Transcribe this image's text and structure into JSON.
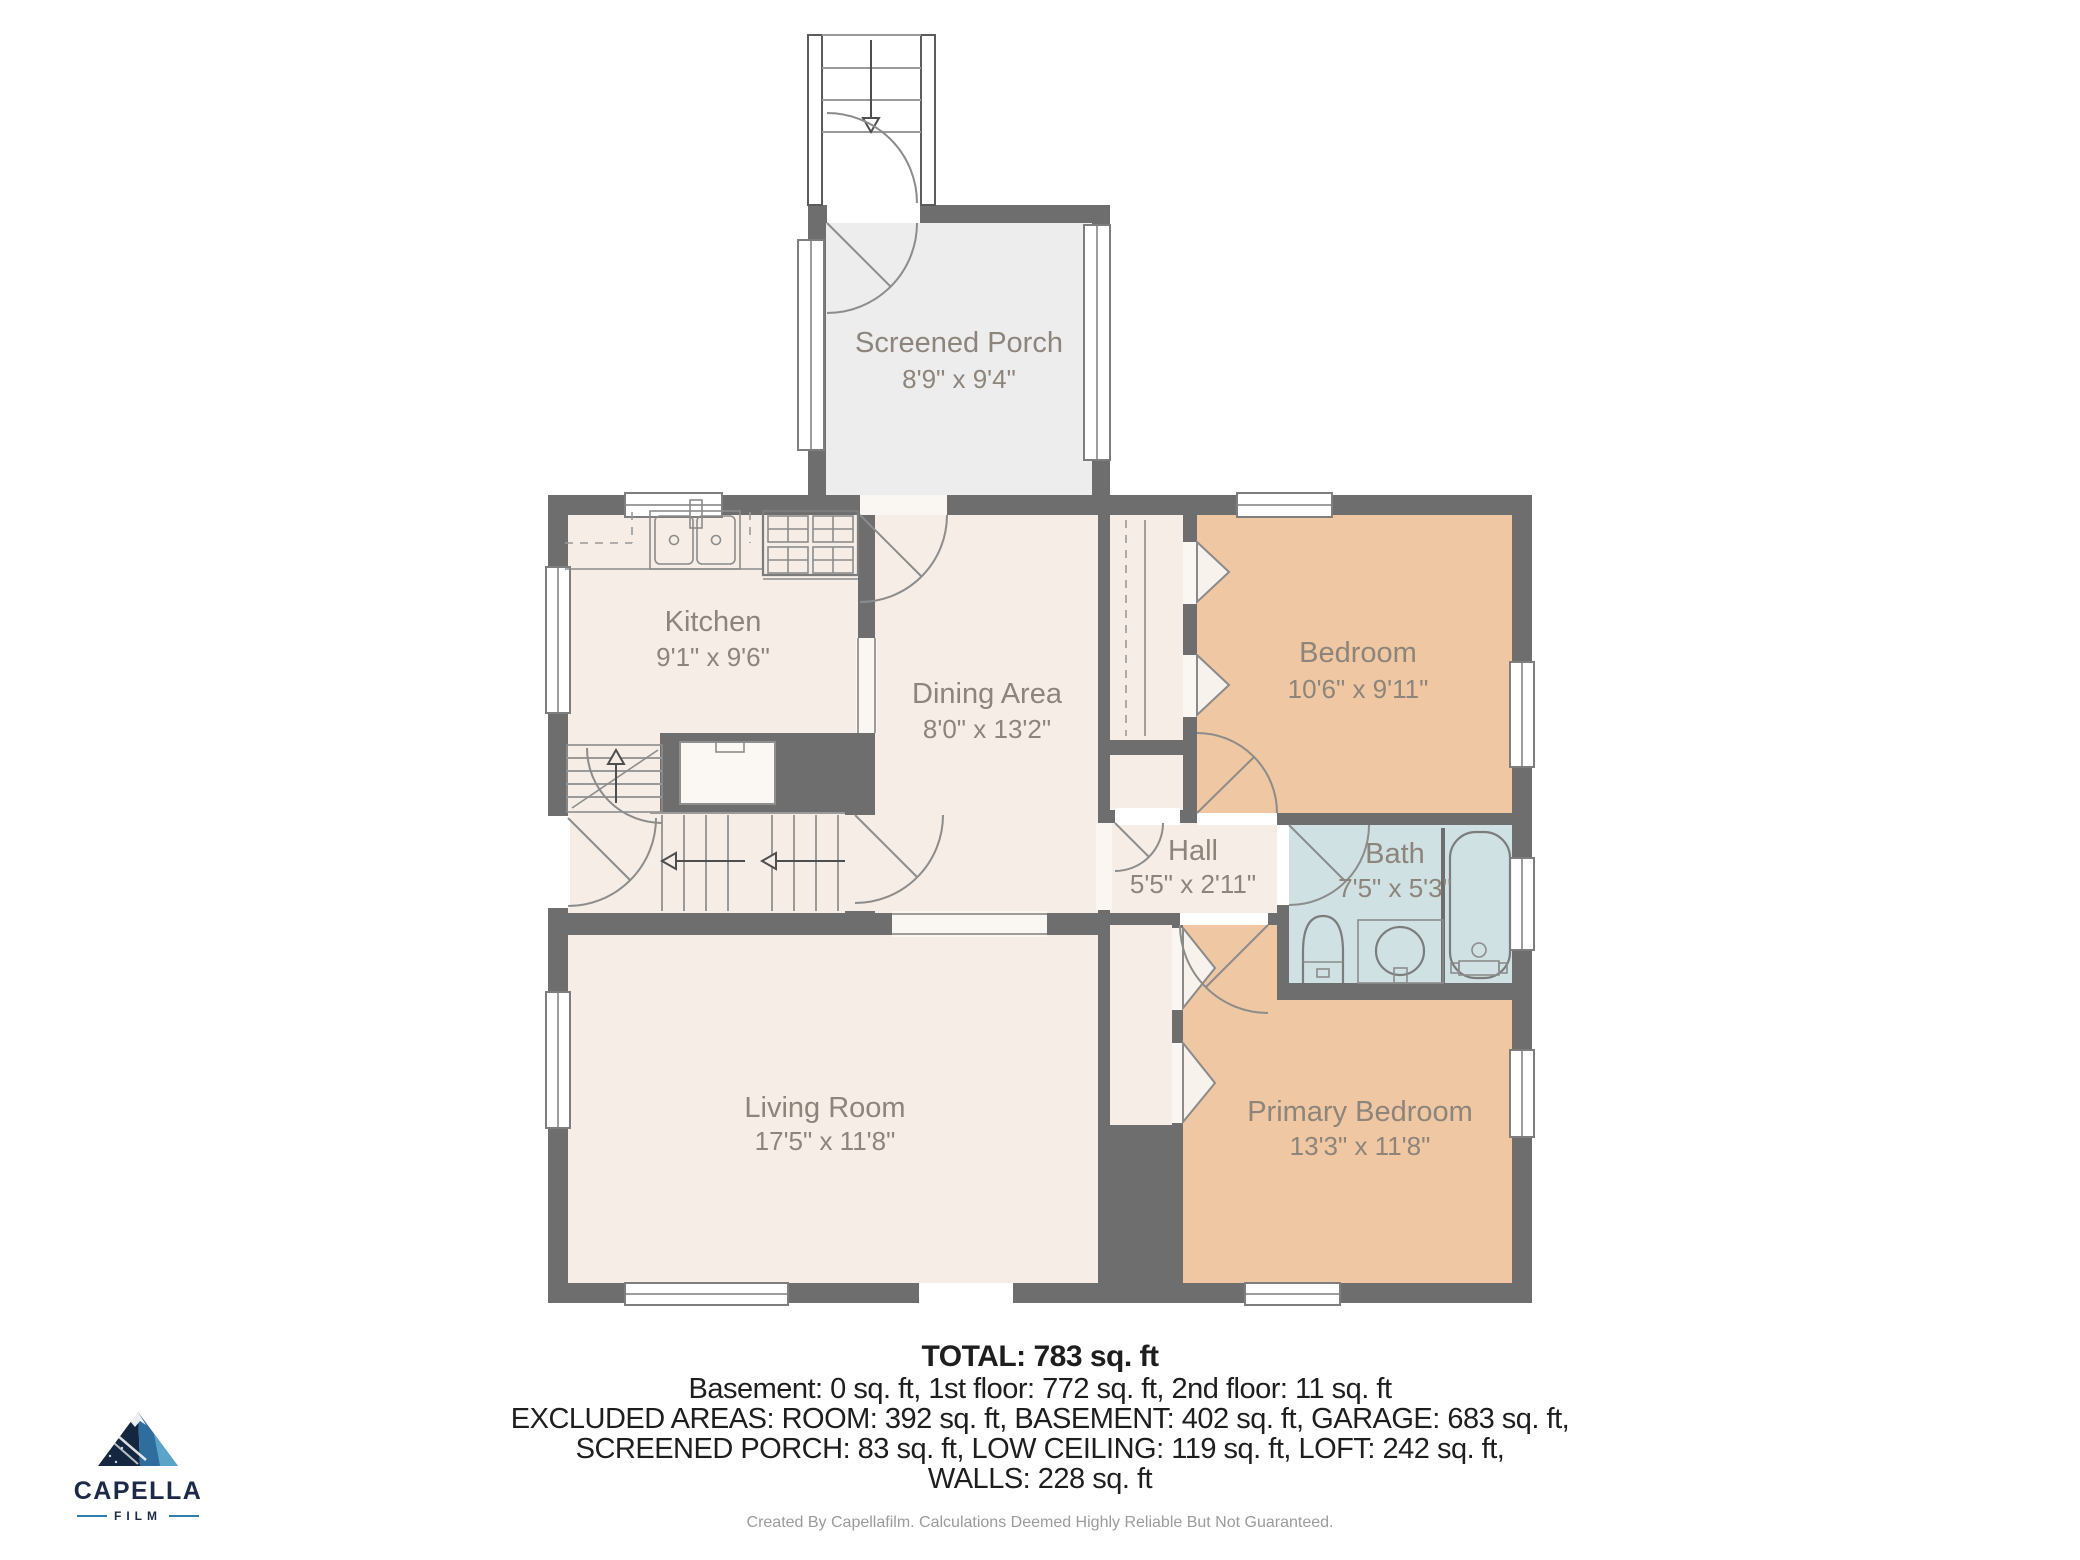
{
  "rooms": [
    {
      "name": "Screened Porch",
      "dims": "8'9\" x 9'4\""
    },
    {
      "name": "Kitchen",
      "dims": "9'1\" x 9'6\""
    },
    {
      "name": "Dining Area",
      "dims": "8'0\" x 13'2\""
    },
    {
      "name": "Bedroom",
      "dims": "10'6\" x 9'11\""
    },
    {
      "name": "Hall",
      "dims": "5'5\" x 2'11\""
    },
    {
      "name": "Bath",
      "dims": "7'5\" x 5'3\""
    },
    {
      "name": "Living Room",
      "dims": "17'5\" x 11'8\""
    },
    {
      "name": "Primary Bedroom",
      "dims": "13'3\" x 11'8\""
    }
  ],
  "summary": {
    "total": "TOTAL: 783 sq. ft",
    "floors": "Basement: 0 sq. ft, 1st floor: 772 sq. ft, 2nd floor: 11 sq. ft",
    "excluded1": "EXCLUDED AREAS: ROOM: 392 sq. ft, BASEMENT: 402 sq. ft, GARAGE: 683 sq. ft,",
    "excluded2": "SCREENED PORCH: 83 sq. ft, LOW CEILING: 119 sq. ft, LOFT: 242 sq. ft,",
    "excluded3": "WALLS: 228 sq. ft"
  },
  "logo": {
    "brand": "CAPELLA",
    "sub": "FILM"
  },
  "footer": "Created By Capellafilm. Calculations Deemed Highly Reliable But Not Guaranteed.",
  "colors": {
    "wall": "#6e6e6e",
    "room_cream": "#f5ede6",
    "room_tan": "#efc7a2",
    "room_bath": "#cfe1e2",
    "room_porch": "#ededed",
    "label_text": "#8d857c",
    "logo_navy": "#1c2a47",
    "logo_blue": "#2d7ea8"
  }
}
